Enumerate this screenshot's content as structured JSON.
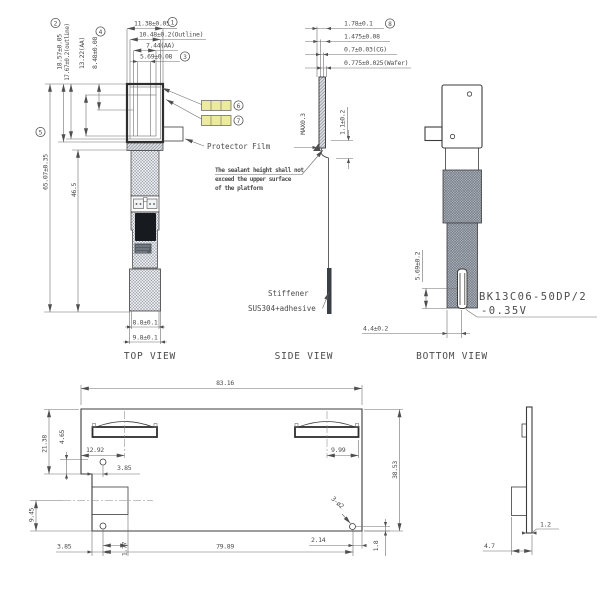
{
  "colors": {
    "highlight": "#ece9a0",
    "line": "#3c3c3c",
    "ic_chip": "#171a1f"
  },
  "balloons": {
    "b1": "1",
    "b2": "2",
    "b3": "3",
    "b4": "4",
    "b5": "5",
    "b6": "6",
    "b7": "7",
    "b8": "8"
  },
  "top_view": {
    "label": "TOP VIEW",
    "dim_width_glass": "11.38±0.05",
    "dim_width_outline": "10.48±0.2(Outline)",
    "dim_width_aa": "7.44(AA)",
    "dim_width_inner": "5.69±0.08",
    "dim_height_glass": "18.57±0.05",
    "dim_height_outline": "17.67±0.2(outline)",
    "dim_height_aa": "13.22(AA)",
    "dim_height_inner": "8.48±0.08",
    "dim_total_length": "65.07±0.35",
    "dim_fpc_length": "46.5",
    "dim_tail_width": "8.8±0.1",
    "dim_stiffener_width": "9.8±0.1",
    "protector_film_label": "Protector Film"
  },
  "side_view": {
    "label": "SIDE VIEW",
    "dim_total_thickness": "1.78±0.1",
    "dim_module_thickness": "1.475±0.08",
    "dim_cg_thickness": "0.7±0.03(CG)",
    "dim_wafer_thickness": "0.775±0.025(Wafer)",
    "dim_sealant_max": "MAX0.3",
    "dim_bend": "1.1±0.2",
    "sealant_note_line1": "The sealant height shall not",
    "sealant_note_line2": "exceed the upper surface",
    "sealant_note_line3": "of the platform",
    "stiffener_label_line1": "Stiffener",
    "stiffener_label_line2": "SUS304+adhesive"
  },
  "bottom_view": {
    "label": "BOTTOM VIEW",
    "dim_connector": "5.69±0.2",
    "dim_connector_offset": "4.4±0.2",
    "connector_part_line1": "BK13C06-50DP/2",
    "connector_part_line2": "-0.35V"
  },
  "outline_view": {
    "dim_overall_width": "83.16",
    "dim_overall_height": "38.53",
    "dim_left_height": "21.38",
    "dim_step_height": "4.65",
    "dim_clip_left_x": "12.92",
    "dim_hole_top_x": "3.85",
    "dim_left_lower_height": "9.45",
    "dim_hole_bottom_x": "3.85",
    "dim_hole_bottom_x2": "1.77",
    "dim_hole_span": "79.89",
    "dim_clip_right_x": "9.99",
    "dim_hole_right_x": "2.14",
    "dim_hole_right_y": "1.8",
    "holes_callout": "3-ø2"
  },
  "profile_view": {
    "dim_thickness": "1.2",
    "dim_depth": "4.7"
  }
}
